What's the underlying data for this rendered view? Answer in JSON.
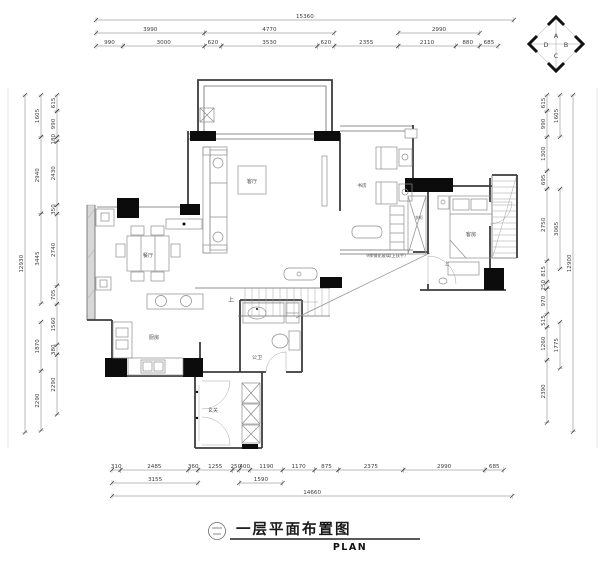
{
  "title_block": {
    "detail_symbol": "二",
    "drawing_title": "一层平面布置图",
    "drawing_subtitle": "PLAN"
  },
  "compass": {
    "letters": [
      "A",
      "B",
      "C",
      "D"
    ]
  },
  "plan_labels": [
    {
      "t": "客厅",
      "x": 252,
      "y": 183,
      "s": 5.2
    },
    {
      "t": "餐厅",
      "x": 148,
      "y": 257,
      "s": 5.2
    },
    {
      "t": "厨房",
      "x": 154,
      "y": 339,
      "s": 5.2
    },
    {
      "t": "书房",
      "x": 362,
      "y": 187,
      "s": 4.8
    },
    {
      "t": "衣柜",
      "x": 419,
      "y": 219,
      "s": 4.0
    },
    {
      "t": "客房",
      "x": 471,
      "y": 236,
      "s": 5.2
    },
    {
      "t": "公卫",
      "x": 257,
      "y": 359,
      "s": 5.0
    },
    {
      "t": "玄关",
      "x": 213,
      "y": 412,
      "s": 5.0
    },
    {
      "t": "上",
      "x": 231,
      "y": 302,
      "s": 6.0
    },
    {
      "t": "上",
      "x": 447,
      "y": 265,
      "s": 4.5
    },
    {
      "t": "9厚钢化玻璃(上扶手)",
      "x": 386,
      "y": 257,
      "s": 4.2
    }
  ],
  "dim_chains": [
    {
      "name": "top",
      "dir": "h",
      "origin": 96,
      "scale": 0.0272,
      "rows": [
        {
          "pos": 20,
          "segs": [
            {
              "v": 15360
            }
          ]
        },
        {
          "pos": 33,
          "segs": [
            {
              "v": 3990
            },
            {
              "v": 4770
            },
            {
              "g": 2355
            },
            {
              "v": 2990
            },
            {
              "g": 685
            }
          ]
        },
        {
          "pos": 46,
          "segs": [
            {
              "v": 990
            },
            {
              "v": 3000
            },
            {
              "v": 620
            },
            {
              "v": 3530
            },
            {
              "v": 620
            },
            {
              "v": 2355
            },
            {
              "v": 2110
            },
            {
              "v": 880
            },
            {
              "v": 685
            }
          ]
        }
      ]
    },
    {
      "name": "bottom",
      "dir": "h",
      "origin": 112,
      "scale": 0.0273,
      "rows": [
        {
          "pos": 470,
          "segs": [
            {
              "v": 310
            },
            {
              "v": 2485
            },
            {
              "v": 360
            },
            {
              "v": 1255
            },
            {
              "v": 250
            },
            {
              "v": 400
            },
            {
              "v": 1190
            },
            {
              "v": 1170
            },
            {
              "v": 875
            },
            {
              "v": 2375
            },
            {
              "v": 2990
            },
            {
              "v": 685
            }
          ]
        },
        {
          "pos": 483,
          "segs": [
            {
              "v": 3155
            },
            {
              "g": 1505
            },
            {
              "v": 1590
            }
          ]
        },
        {
          "pos": 496,
          "segs": [
            {
              "v": 14660
            }
          ]
        }
      ]
    },
    {
      "name": "left",
      "dir": "v",
      "origin": 95,
      "scale": 0.0261,
      "rows": [
        {
          "pos": 57,
          "segs": [
            {
              "v": 615
            },
            {
              "v": 990
            },
            {
              "v": 180
            },
            {
              "v": 2430
            },
            {
              "v": 350
            },
            {
              "v": 2740
            },
            {
              "v": 705
            },
            {
              "v": 1560
            },
            {
              "v": 380
            },
            {
              "v": 2290
            }
          ]
        },
        {
          "pos": 41,
          "segs": [
            {
              "v": 1605
            },
            {
              "v": 2940
            },
            {
              "v": 3445
            },
            {
              "g": 705
            },
            {
              "v": 1870
            },
            {
              "v": 2290
            }
          ]
        },
        {
          "pos": 25,
          "segs": [
            {
              "v": 12930
            }
          ]
        }
      ]
    },
    {
      "name": "right",
      "dir": "v",
      "origin": 95,
      "scale": 0.0261,
      "rows": [
        {
          "pos": 547,
          "segs": [
            {
              "v": 615
            },
            {
              "v": 990
            },
            {
              "v": 1300
            },
            {
              "v": 695
            },
            {
              "v": 2750
            },
            {
              "v": 815
            },
            {
              "v": 250
            },
            {
              "v": 970
            },
            {
              "v": 515
            },
            {
              "v": 1260
            },
            {
              "v": 2390
            }
          ]
        },
        {
          "pos": 560,
          "segs": [
            {
              "v": 1605
            },
            {
              "g": 1995
            },
            {
              "v": 3065
            },
            {
              "g": 2035
            },
            {
              "v": 1775
            },
            {
              "g": 2390
            }
          ]
        },
        {
          "pos": 573,
          "segs": [
            {
              "v": 12900
            }
          ]
        }
      ]
    }
  ]
}
